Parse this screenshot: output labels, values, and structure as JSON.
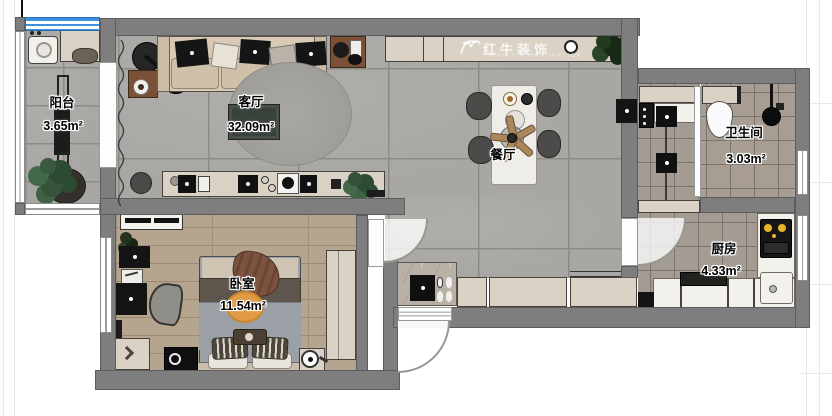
{
  "watermark": {
    "name": "红牛装饰",
    "subtitle": "HONG NIU DECORATION"
  },
  "rooms": {
    "balcony": {
      "name": "阳台",
      "area": "3.65m²"
    },
    "living": {
      "name": "客厅",
      "area": "32.09m²"
    },
    "dining": {
      "name": "餐厅",
      "area": ""
    },
    "bathroom": {
      "name": "卫生间",
      "area": "3.03m²"
    },
    "kitchen": {
      "name": "厨房",
      "area": "4.33m²"
    },
    "bedroom": {
      "name": "卧室",
      "area": "11.54m²"
    }
  },
  "colors": {
    "wall": "#7e7e7e",
    "tile_floor": "#a9a7a3",
    "small_tile_floor": "#a49b92",
    "wood_floor": "#b5a48e",
    "cabinet_beige": "#d9d2c5",
    "window_blue": "#3e8fdd",
    "rug_orange": "#e09a43",
    "stove_flame_yellow": "#e8b42a"
  }
}
